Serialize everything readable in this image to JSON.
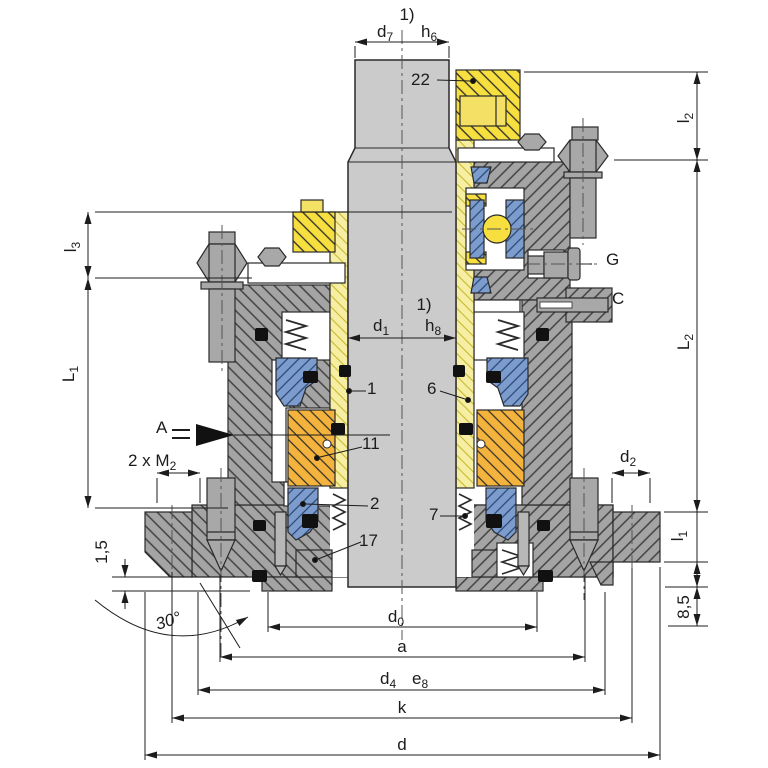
{
  "colors": {
    "shaft_gray": "#cbcbcb",
    "steel_gray": "#a8a8a8",
    "housing_gray": "#a4a4a4",
    "hatch_dark": "#3c3c3c",
    "sleeve_yellow": "#f6efa3",
    "collar_yellow": "#f7df3f",
    "seal_gold": "#f3b33c",
    "seat_blue": "#7d9cce",
    "oring_black": "#111111",
    "line": "#222222"
  },
  "footnotes": {
    "top": "1)",
    "mid": "1)"
  },
  "dims": {
    "d7": {
      "base": "d",
      "sub": "7"
    },
    "h6": {
      "base": "h",
      "sub": "6"
    },
    "d1": {
      "base": "d",
      "sub": "1"
    },
    "h8": {
      "base": "h",
      "sub": "8"
    },
    "d0": {
      "base": "d",
      "sub": "0"
    },
    "d4": {
      "base": "d",
      "sub": "4"
    },
    "e8": {
      "base": "e",
      "sub": "8"
    },
    "d2": {
      "base": "d",
      "sub": "2"
    },
    "m2": {
      "base": "2 x M",
      "sub": "2"
    },
    "l1": {
      "base": "l",
      "sub": "1"
    },
    "l2": {
      "base": "l",
      "sub": "2"
    },
    "l3": {
      "base": "l",
      "sub": "3"
    },
    "L1": {
      "base": "L",
      "sub": "1"
    },
    "L2": {
      "base": "L",
      "sub": "2"
    },
    "a": "a",
    "k": "k",
    "d": "d",
    "gap": "1,5",
    "offset": "8,5",
    "angle": "30°"
  },
  "parts": {
    "p22": "22",
    "p1": "1",
    "p6": "6",
    "p11": "11",
    "p2": "2",
    "p7": "7",
    "p17": "17"
  },
  "letters": {
    "flow": "A",
    "grease": "G",
    "pin": "C"
  }
}
